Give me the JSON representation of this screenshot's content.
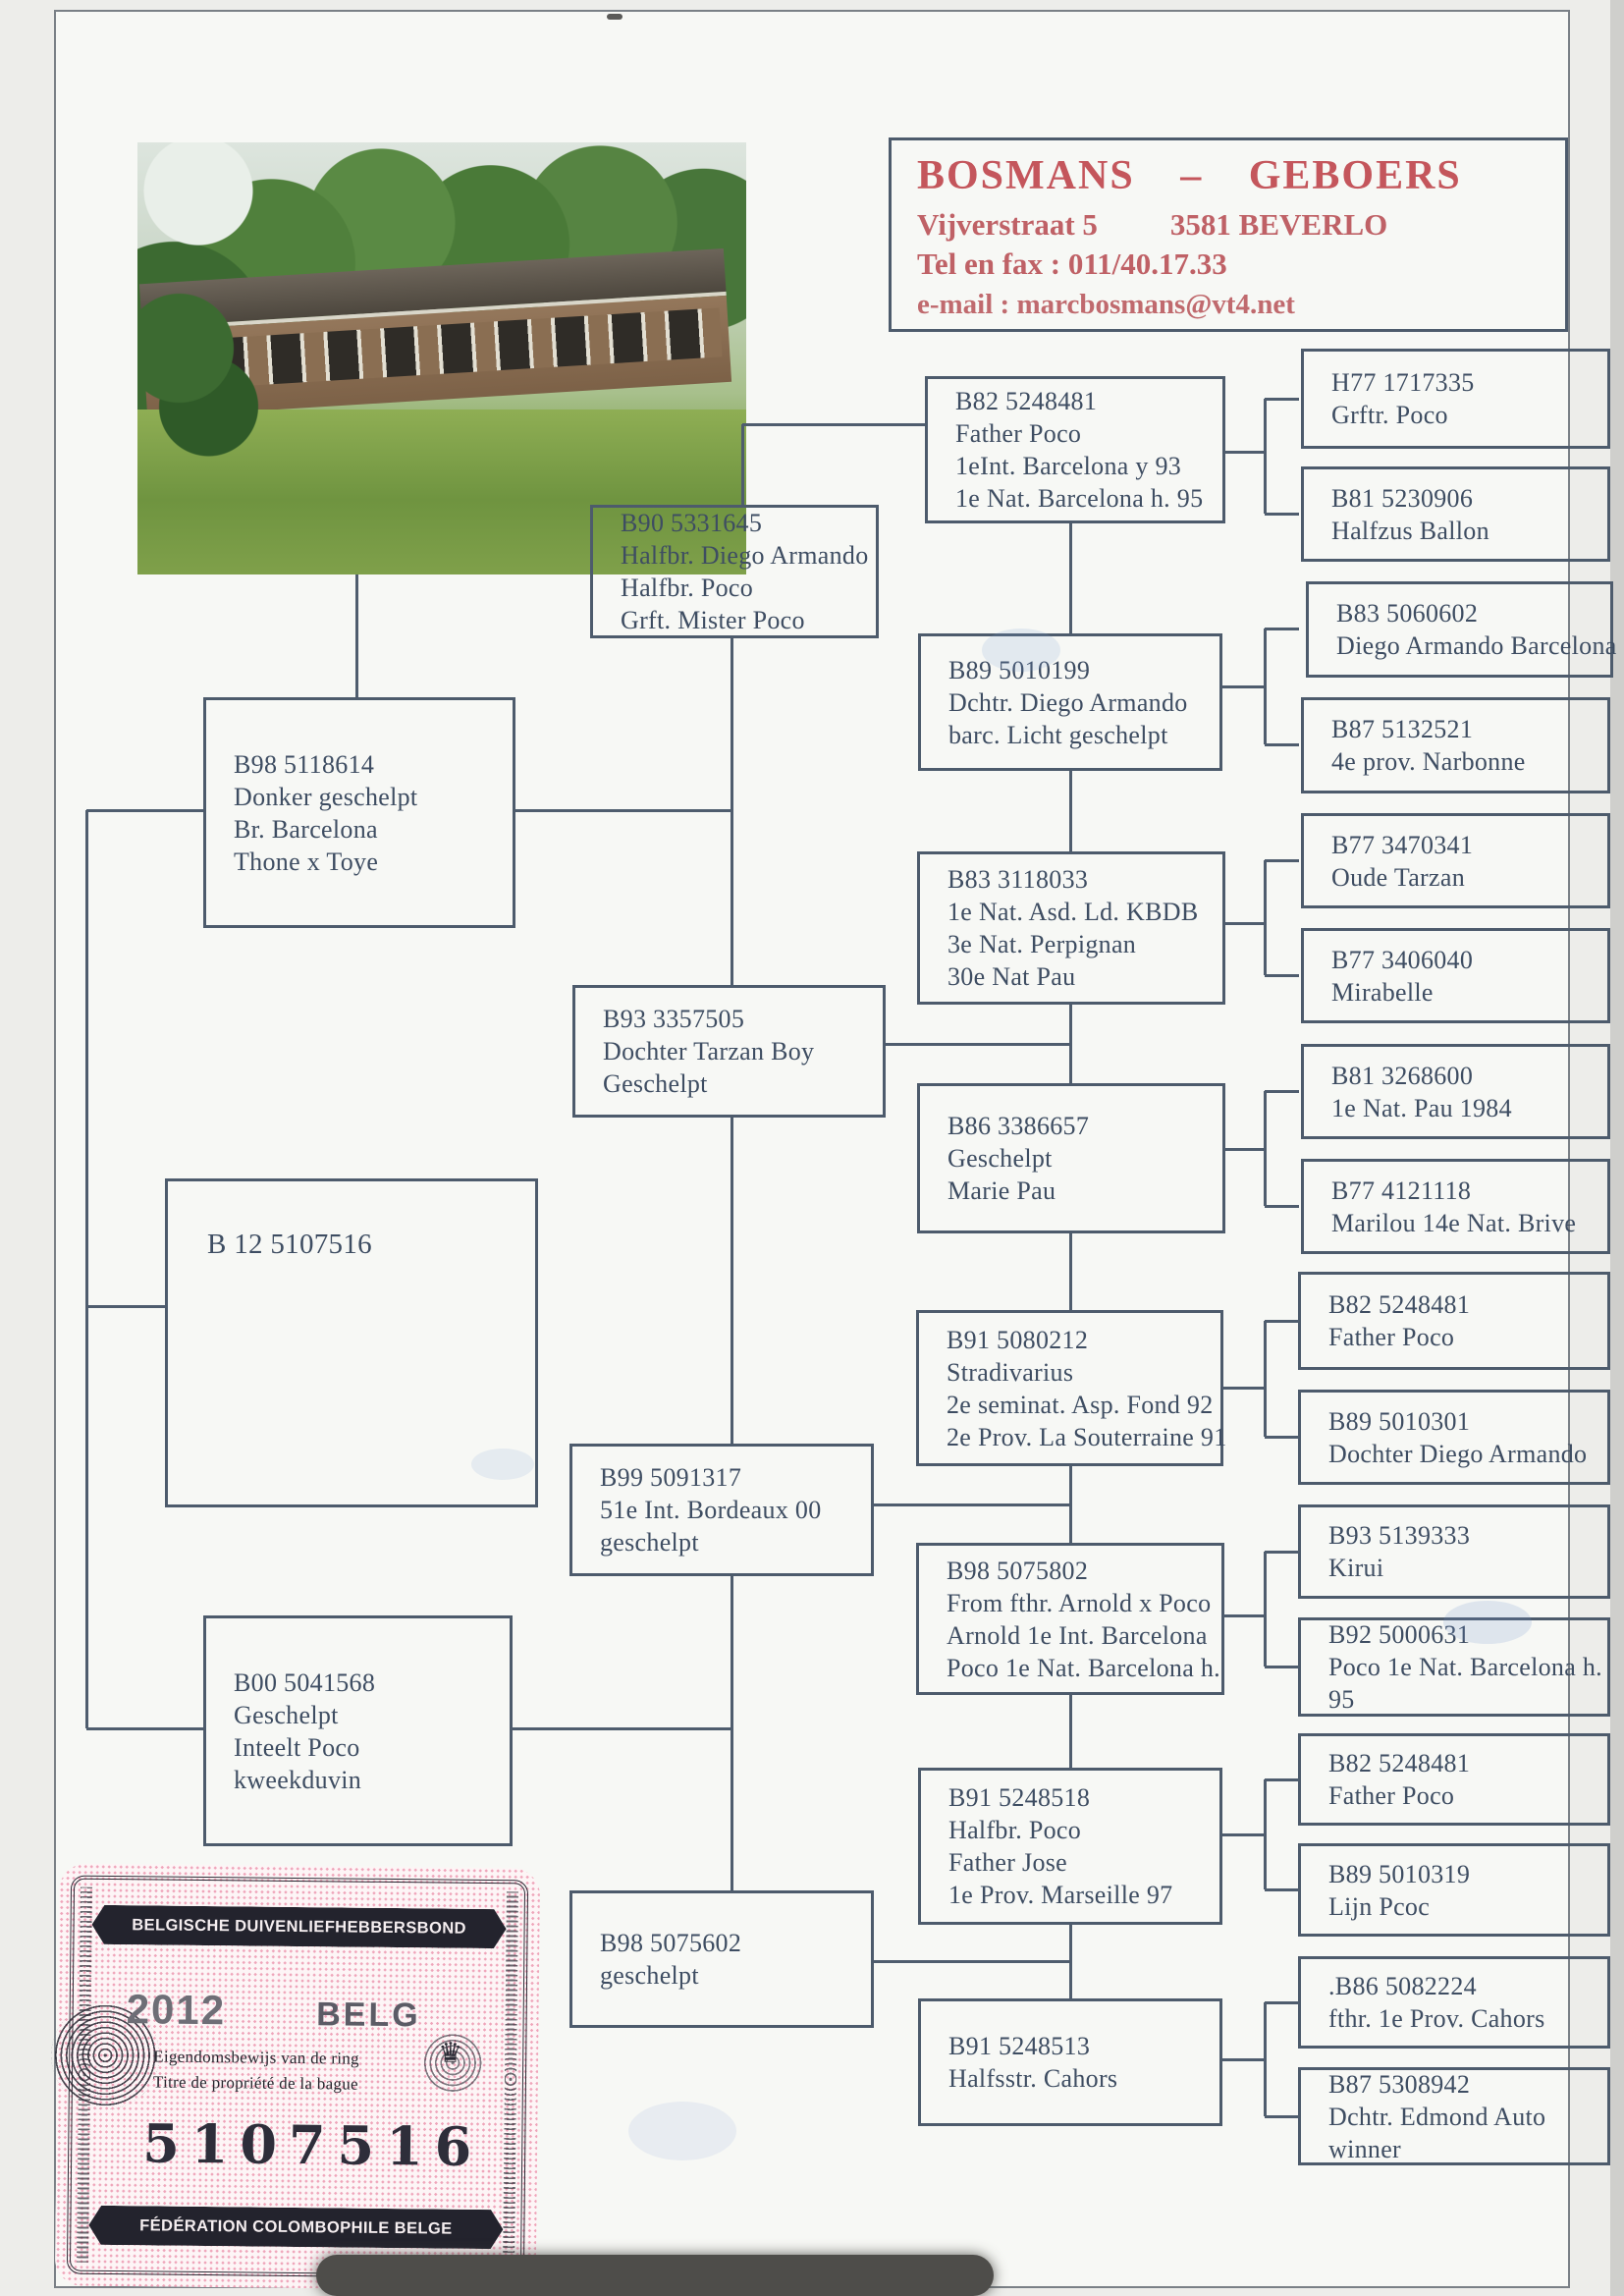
{
  "header": {
    "name": "BOSMANS – GEBOERS",
    "street": "Vijverstraat 5",
    "city": "3581 BEVERLO",
    "phone": "Tel en fax : 011/40.17.33",
    "email": "e-mail : marcbosmans@vt4.net"
  },
  "pedigree": {
    "boxes": [
      {
        "key": "b98-5118614",
        "lines": [
          "B98 5118614",
          "Donker geschelpt",
          "Br. Barcelona",
          "Thone x Toye"
        ]
      },
      {
        "key": "b12-5107516",
        "lines": [
          "B 12 5107516"
        ]
      },
      {
        "key": "b00-5041568",
        "lines": [
          "B00 5041568",
          "Geschelpt",
          "Inteelt Poco",
          "kweekduvin"
        ]
      },
      {
        "key": "b90-5331645",
        "lines": [
          "B90 5331645",
          "Halfbr. Diego Armando",
          "Halfbr. Poco",
          "Grft. Mister Poco"
        ]
      },
      {
        "key": "b93-3357505",
        "lines": [
          "B93 3357505",
          "Dochter Tarzan Boy",
          "Geschelpt"
        ]
      },
      {
        "key": "b99-5091317",
        "lines": [
          "B99 5091317",
          "51e Int. Bordeaux 00",
          "geschelpt"
        ]
      },
      {
        "key": "b98-5075602",
        "lines": [
          "B98 5075602",
          "geschelpt"
        ]
      },
      {
        "key": "b82-5248481-sire",
        "lines": [
          "B82 5248481",
          "Father Poco",
          "1eInt. Barcelona y 93",
          "1e Nat. Barcelona h. 95"
        ]
      },
      {
        "key": "b89-5010199",
        "lines": [
          "B89 5010199",
          "Dchtr. Diego Armando",
          "barc. Licht geschelpt"
        ]
      },
      {
        "key": "b83-3118033",
        "lines": [
          "B83 3118033",
          "1e Nat. Asd. Ld. KBDB",
          "3e Nat. Perpignan",
          "30e Nat Pau"
        ]
      },
      {
        "key": "b86-3386657",
        "lines": [
          "B86 3386657",
          "Geschelpt",
          "Marie Pau"
        ]
      },
      {
        "key": "b91-5080212",
        "lines": [
          "B91 5080212",
          "Stradivarius",
          "2e seminat. Asp. Fond 92",
          "2e Prov. La Souterraine 91"
        ]
      },
      {
        "key": "b98-5075802",
        "lines": [
          "B98 5075802",
          "From fthr. Arnold x Poco",
          "Arnold 1e Int. Barcelona",
          "Poco 1e Nat. Barcelona h."
        ]
      },
      {
        "key": "b91-5248518",
        "lines": [
          "B91 5248518",
          "Halfbr. Poco",
          "Father Jose",
          "1e Prov. Marseille 97"
        ]
      },
      {
        "key": "b91-5248513",
        "lines": [
          "B91 5248513",
          "Halfsstr. Cahors"
        ]
      },
      {
        "key": "h77-1717335",
        "lines": [
          "H77 1717335",
          "Grftr. Poco"
        ]
      },
      {
        "key": "b81-5230906",
        "lines": [
          "B81 5230906",
          "Halfzus Ballon"
        ]
      },
      {
        "key": "b83-5060602",
        "lines": [
          "B83 5060602",
          "Diego Armando Barcelona"
        ]
      },
      {
        "key": "b87-5132521",
        "lines": [
          "B87 5132521",
          "4e prov. Narbonne"
        ]
      },
      {
        "key": "b77-3470341",
        "lines": [
          "B77 3470341",
          "Oude Tarzan"
        ]
      },
      {
        "key": "b77-3406040",
        "lines": [
          "B77 3406040",
          "Mirabelle"
        ]
      },
      {
        "key": "b81-3268600",
        "lines": [
          "B81 3268600",
          "1e Nat. Pau 1984"
        ]
      },
      {
        "key": "b77-4121118",
        "lines": [
          "B77 4121118",
          "Marilou 14e Nat. Brive"
        ]
      },
      {
        "key": "b82-5248481-b",
        "lines": [
          "B82 5248481",
          "Father Poco"
        ]
      },
      {
        "key": "b89-5010301",
        "lines": [
          "B89 5010301",
          "Dochter Diego Armando"
        ]
      },
      {
        "key": "b93-5139333",
        "lines": [
          "B93 5139333",
          "Kirui"
        ]
      },
      {
        "key": "b92-5000631",
        "lines": [
          "B92 5000631",
          "Poco 1e Nat. Barcelona h.",
          "95"
        ]
      },
      {
        "key": "b82-5248481-c",
        "lines": [
          "B82 5248481",
          "Father Poco"
        ]
      },
      {
        "key": "b89-5010319",
        "lines": [
          "B89 5010319",
          "Lijn Pcoc"
        ]
      },
      {
        "key": "b86-5082224",
        "lines": [
          ".B86 5082224",
          "fthr. 1e Prov. Cahors"
        ]
      },
      {
        "key": "b87-5308942",
        "lines": [
          "B87 5308942",
          "Dchtr. Edmond Auto",
          "winner"
        ]
      }
    ]
  },
  "stamp": {
    "top_banner": "BELGISCHE DUIVENLIEFHEBBERSBOND",
    "year": "2012",
    "country": "BELG",
    "line_nl": "Eigendomsbewijs van de ring",
    "line_fr": "Titre de propriété de la bague",
    "ring_number": "5107516",
    "bottom_banner": "FÉDÉRATION COLOMBOPHILE BELGE"
  },
  "colors": {
    "ink_blue": "#3e4d62",
    "connector_line": "#4f5d6e",
    "header_red": "#c4565c",
    "stamp_pink": "#efa5ba",
    "stamp_ink": "#26262e"
  }
}
